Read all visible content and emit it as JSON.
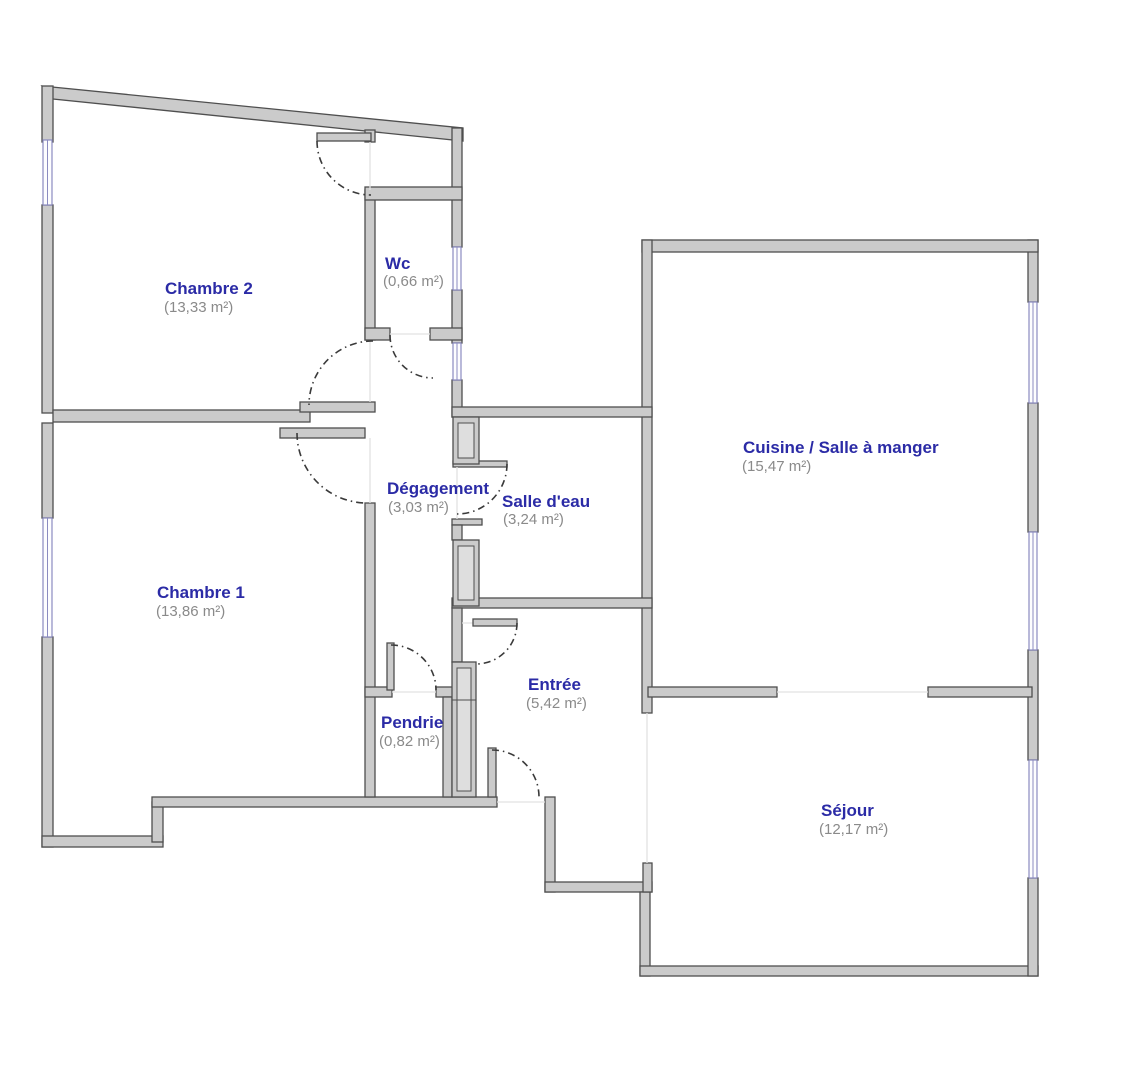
{
  "diagram": {
    "type": "floor-plan",
    "language": "fr",
    "description": "Apartment floor plan with room names and surface areas"
  },
  "rooms": [
    {
      "id": "chambre-2",
      "name": "Chambre 2",
      "area": "(13,33 m²)"
    },
    {
      "id": "wc",
      "name": "Wc",
      "area": "(0,66 m²)"
    },
    {
      "id": "chambre-1",
      "name": "Chambre 1",
      "area": "(13,86 m²)"
    },
    {
      "id": "degagement",
      "name": "Dégagement",
      "area": "(3,03 m²)"
    },
    {
      "id": "salle-deau",
      "name": "Salle d'eau",
      "area": "(3,24 m²)"
    },
    {
      "id": "cuisine",
      "name": "Cuisine / Salle à manger",
      "area": "(15,47 m²)"
    },
    {
      "id": "entree",
      "name": "Entrée",
      "area": "(5,42 m²)"
    },
    {
      "id": "pendrie",
      "name": "Pendrie",
      "area": "(0,82 m²)"
    },
    {
      "id": "sejour",
      "name": "Séjour",
      "area": "(12,17 m²)"
    }
  ],
  "colors": {
    "wall_fill": "#cbcbcb",
    "wall_outline": "#4f4f4f",
    "window": "#8b8bc0",
    "door_swing": "#3a3a3a",
    "room_name": "#2b2ba6",
    "room_area": "#8a8a8a",
    "background": "#ffffff"
  },
  "counts": {
    "windows": 7,
    "door_swings": 8,
    "technical_shafts": 3
  }
}
